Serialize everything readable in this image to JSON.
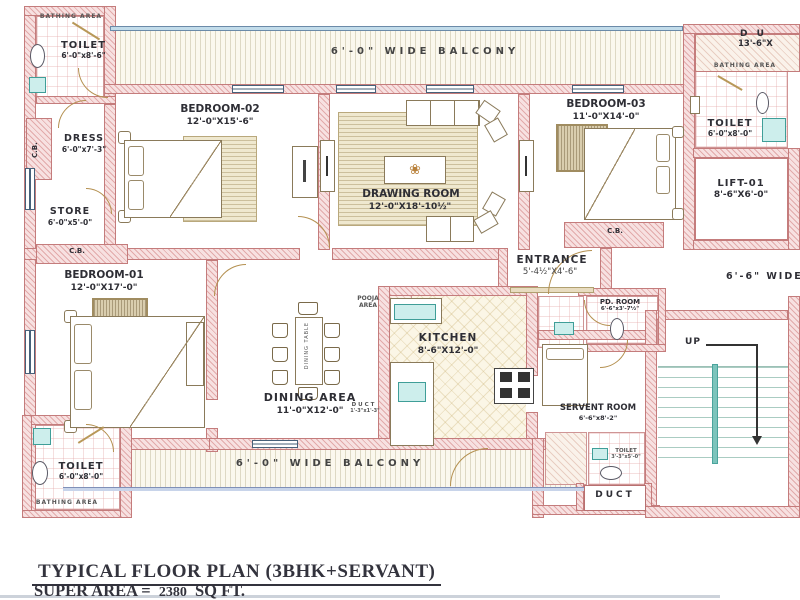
{
  "title": {
    "line1": "TYPICAL FLOOR PLAN (3BHK+SERVANT)",
    "area_label": "SUPER AREA =",
    "area_value": "2380",
    "area_unit": "SQ FT."
  },
  "shared": {
    "bathing_area": "BATHING AREA",
    "cupboard": "C.B.",
    "balcony_top": "6'-0\" WIDE BALCONY",
    "balcony_bottom": "6'-0\" WIDE BALCONY",
    "corridor": "6'-6\" WIDE",
    "up": "UP",
    "pooja": "POOJA AREA",
    "dining_table": "DINING TABLE",
    "flower_icon": "❀"
  },
  "rooms": {
    "toilet_top_left": {
      "name": "TOILET",
      "dims": "6'-0\"x8'-6\""
    },
    "dress": {
      "name": "DRESS",
      "dims": "6'-0\"x7'-3\""
    },
    "store": {
      "name": "STORE",
      "dims": "6'-0\"x5'-0\""
    },
    "bedroom_01": {
      "name": "BEDROOM-01",
      "dims": "12'-0\"X17'-0\""
    },
    "bedroom_02": {
      "name": "BEDROOM-02",
      "dims": "12'-0\"X15'-6\""
    },
    "bedroom_03": {
      "name": "BEDROOM-03",
      "dims": "11'-0\"X14'-0\""
    },
    "drawing_room": {
      "name": "DRAWING ROOM",
      "dims": "12'-0\"X18'-10½\""
    },
    "dining_area": {
      "name": "DINING AREA",
      "dims": "11'-0\"X12'-0\""
    },
    "kitchen": {
      "name": "KITCHEN",
      "dims": "8'-6\"X12'-0\""
    },
    "entrance": {
      "name": "ENTRANCE",
      "dims": "5'-4½\"X4'-6\""
    },
    "pd_room": {
      "name": "PD. ROOM",
      "dims": "6'-6\"x3'-7½\""
    },
    "lift": {
      "name": "LIFT-01",
      "dims": "8'-6\"X6'-0\""
    },
    "toilet_top_right": {
      "name": "TOILET",
      "dims": "6'-0\"x8'-0\""
    },
    "duct_top_right": {
      "name": "D U",
      "dims": "13'-6\"X"
    },
    "servant_room": {
      "name": "SERVENT ROOM",
      "dims": "6'-6\"x8'-2\""
    },
    "servant_toilet": {
      "name": "TOILET",
      "dims": "3'-3\"x5'-0\""
    },
    "duct_bottom": {
      "name": "DUCT"
    },
    "duct_small": {
      "name": "DUCT",
      "dims": "1'-3\"x1'-3\""
    },
    "toilet_bottom_left": {
      "name": "TOILET",
      "dims": "6'-0\"x8'-0\""
    }
  }
}
